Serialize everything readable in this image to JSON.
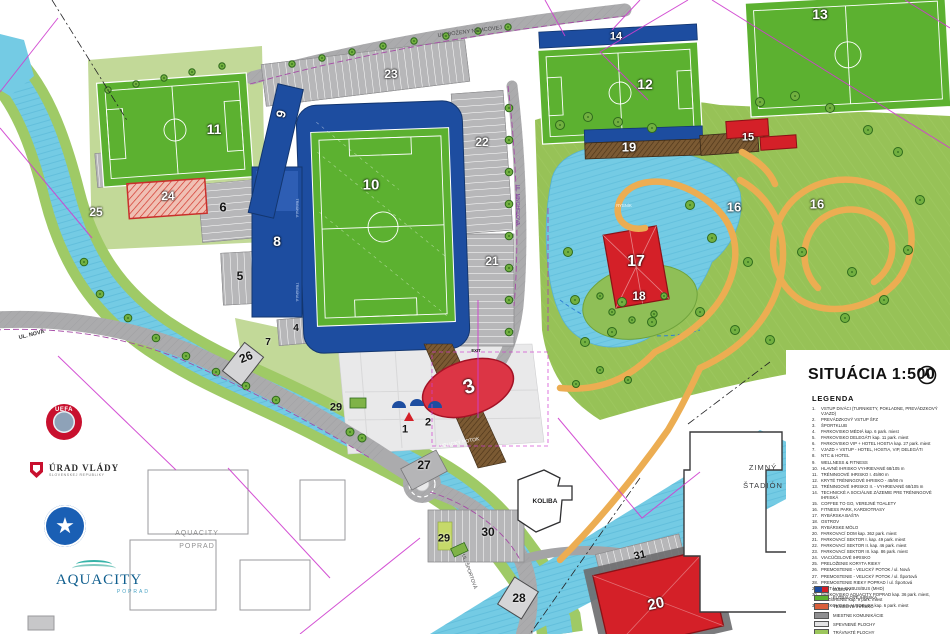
{
  "title_block": {
    "title": "SITUÁCIA 1:500",
    "legend_heading": "LEGENDA"
  },
  "legend": {
    "items": [
      "VSTUP DIVÁCI (TURNIKETY, POKLADNE, PREVÁDZKOVÝ VJAZD)",
      "PREVÁDZKOVÝ VSTUP ŠFZ",
      "ŠPORTKLUB",
      "PARKOVISKO MÉDIÁ  kap. 6 park. miest",
      "PARKOVISKO DELEGÁTI  kap. 11 park. miest",
      "PARKOVISKO VIP + HOTEL HOSTIA  kap. 27 park. miest",
      "VJAZD + VSTUP - HOTEL, HOSTIA, VIP, DELEGÁTI",
      "NTC & HOTEL",
      "WELLNESS & FITNESS",
      "HLAVNÉ IHRISKO VYHRIEVANÉ 68/105 m",
      "TRÉNINGOVÉ IHRISKO I.  45/90 m",
      "KRYTÉ TRÉNINGOVÉ IHRISKO - 45/90 m",
      "TRÉNINGOVÉ IHRISKO II. - VYHRIEVANÉ 68/105 m",
      "TECHNICKÉ A SOCIÁLNE ZÁZEMIE PRE TRÉNINGOVÉ IHRISKÁ",
      "COFFEE TO GO, VEREJNÉ TOALETY",
      "FITNESS PARK, KARDIOTRASY",
      "RYBÁRSKA BAŠTA",
      "OSTROV",
      "RYBÁRSKE MÓLO",
      "PARKOVACÍ DOM  kap. 362 park. miest",
      "PARKOVACÍ SEKTOR I.  kap. 49 park. miest",
      "PARKOVACÍ SEKTOR II.  kap. 46 park. miest",
      "PARKOVACÍ SEKTOR III.  kap. 86 park. miest",
      "VIACÚČELOVÉ IHRISKO",
      "PRELOŽENIE KORYTA RIEKY",
      "PREMOSTENIE - VELICKÝ POTOK / ul. Nová",
      "PREMOSTENIE - VELICKÝ POTOK / ul. Športová",
      "PREMOSTENIE RIEKY POPRAD / ul. Športová",
      "ZASTÁVKA SKIBUS/BUS (MHD)",
      "PARKOVISKO AQUACITY POPRAD kap. 36 park. miest, ROZŠÍRENIE kap. 9 park. miest",
      "PARKOVISKO AUTOBUSY  kap. 6 park. miest"
    ]
  },
  "swatches": [
    {
      "label": "BUDOVY",
      "colors": [
        "#1d4da0",
        "#d42028"
      ]
    },
    {
      "label": "FUTBALOVÉ IHRISKÁ",
      "colors": [
        "#5cb130"
      ]
    },
    {
      "label": "TENISOVÉ IHRISKO",
      "colors": [
        "#d95f3b"
      ]
    },
    {
      "label": "MIESTNE KOMUNIKÁCIE",
      "colors": [
        "#8f8f91"
      ]
    },
    {
      "label": "SPEVNENÉ PLOCHY",
      "colors": [
        "#e3e3e4"
      ]
    },
    {
      "label": "TRÁVNATÉ PLOCHY",
      "colors": [
        "#9cc65c"
      ]
    },
    {
      "label": "ŠTRKOVÝ CHODNÍK",
      "colors": [
        "#e8c24d"
      ]
    }
  ],
  "map_markers": [
    {
      "t": "1",
      "x": 405,
      "y": 430,
      "k": "b",
      "s": 11,
      "r": 0
    },
    {
      "t": "2",
      "x": 428,
      "y": 423,
      "k": "b",
      "s": 11,
      "r": 0
    },
    {
      "t": "3",
      "x": 469,
      "y": 387,
      "k": "w",
      "s": 20,
      "r": -18
    },
    {
      "t": "4",
      "x": 296,
      "y": 329,
      "k": "b",
      "s": 10,
      "r": 0
    },
    {
      "t": "5",
      "x": 240,
      "y": 276,
      "k": "b",
      "s": 12,
      "r": 0
    },
    {
      "t": "6",
      "x": 223,
      "y": 207,
      "k": "b",
      "s": 13,
      "r": 0
    },
    {
      "t": "7",
      "x": 268,
      "y": 343,
      "k": "b",
      "s": 10,
      "r": 0
    },
    {
      "t": "8",
      "x": 277,
      "y": 241,
      "k": "w",
      "s": 14,
      "r": 0
    },
    {
      "t": "9",
      "x": 281,
      "y": 114,
      "k": "w",
      "s": 13,
      "r": -75
    },
    {
      "t": "10",
      "x": 371,
      "y": 185,
      "k": "w",
      "s": 15,
      "r": 0
    },
    {
      "t": "11",
      "x": 214,
      "y": 129,
      "k": "w",
      "s": 14,
      "r": 0
    },
    {
      "t": "12",
      "x": 645,
      "y": 84,
      "k": "w",
      "s": 14,
      "r": 0
    },
    {
      "t": "13",
      "x": 820,
      "y": 14,
      "k": "w",
      "s": 14,
      "r": 0
    },
    {
      "t": "14",
      "x": 616,
      "y": 37,
      "k": "w",
      "s": 11,
      "r": 0
    },
    {
      "t": "15",
      "x": 748,
      "y": 138,
      "k": "w",
      "s": 11,
      "r": 0
    },
    {
      "t": "16",
      "x": 734,
      "y": 207,
      "k": "w",
      "s": 13,
      "r": 0
    },
    {
      "t": "16",
      "x": 817,
      "y": 204,
      "k": "w",
      "s": 13,
      "r": 0
    },
    {
      "t": "17",
      "x": 636,
      "y": 262,
      "k": "w",
      "s": 16,
      "r": 0
    },
    {
      "t": "18",
      "x": 639,
      "y": 296,
      "k": "w",
      "s": 12,
      "r": 0
    },
    {
      "t": "19",
      "x": 629,
      "y": 147,
      "k": "w",
      "s": 13,
      "r": 0
    },
    {
      "t": "20",
      "x": 656,
      "y": 604,
      "k": "w",
      "s": 15,
      "r": -12
    },
    {
      "t": "21",
      "x": 492,
      "y": 261,
      "k": "w",
      "s": 12,
      "r": 0
    },
    {
      "t": "22",
      "x": 482,
      "y": 142,
      "k": "w",
      "s": 12,
      "r": 0
    },
    {
      "t": "23",
      "x": 391,
      "y": 74,
      "k": "w",
      "s": 12,
      "r": 0
    },
    {
      "t": "24",
      "x": 168,
      "y": 196,
      "k": "w",
      "s": 12,
      "r": 0
    },
    {
      "t": "25",
      "x": 96,
      "y": 212,
      "k": "w",
      "s": 12,
      "r": 0
    },
    {
      "t": "26",
      "x": 246,
      "y": 357,
      "k": "b",
      "s": 12,
      "r": -22
    },
    {
      "t": "27",
      "x": 424,
      "y": 465,
      "k": "b",
      "s": 12,
      "r": 0
    },
    {
      "t": "28",
      "x": 519,
      "y": 598,
      "k": "b",
      "s": 12,
      "r": 0
    },
    {
      "t": "29",
      "x": 336,
      "y": 408,
      "k": "b",
      "s": 11,
      "r": 0
    },
    {
      "t": "29",
      "x": 444,
      "y": 539,
      "k": "b",
      "s": 11,
      "r": 0
    },
    {
      "t": "30",
      "x": 488,
      "y": 532,
      "k": "b",
      "s": 12,
      "r": 0
    },
    {
      "t": "31",
      "x": 640,
      "y": 556,
      "k": "b",
      "s": 11,
      "r": -12
    }
  ],
  "labels": {
    "bozeny": "UL. BOŽENY NĚMCOVEJ",
    "nova": "UL. NOVÁ",
    "mnohelova": "UL. MNOHEĽOVA",
    "sportova": "UL. ŠPORTOVÁ",
    "velicky": "VELICKÝ POTOK",
    "rybnik": "RYBNÍK",
    "koliba": "KOLIBA",
    "zimny1": "ZIMNÝ",
    "zimny2": "ŠTADIÓN",
    "aqua1": "AQUACITY",
    "aqua2": "POPRAD",
    "tribuna": "TRIBÚNA A",
    "exit": "EXIT"
  },
  "logos": {
    "uefa": "UEFA",
    "urad1": "ÚRAD VLÁDY",
    "urad2": "SLOVENSKEJ REPUBLIKY",
    "sfz_star": "★",
    "aquacity": "AQUACITY",
    "aquacity_sub": "POPRAD"
  }
}
